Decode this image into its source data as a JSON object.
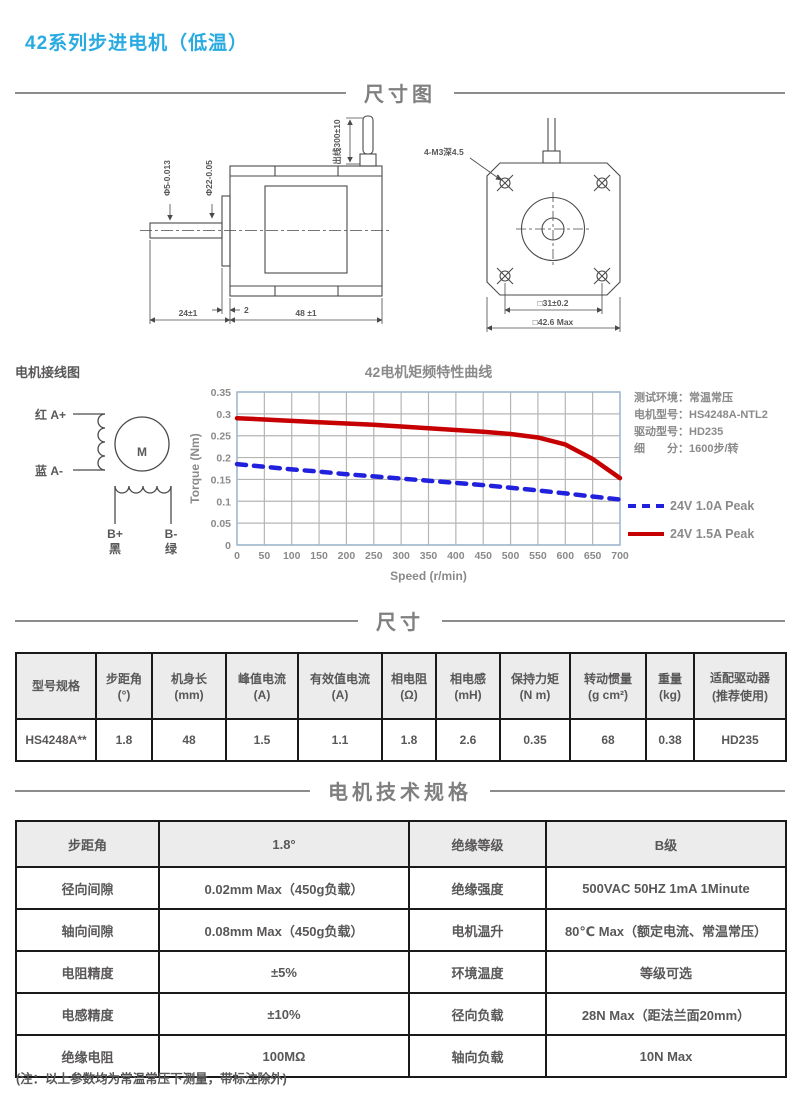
{
  "page": {
    "title": "42系列步进电机（低温）",
    "footnote": "(注：以上参数均为常温常压下测量，带标注除外)",
    "accent_color": "#29abe2"
  },
  "sections": {
    "drawing": "尺寸图",
    "size": "尺寸",
    "tech": "电机技术规格"
  },
  "drawing": {
    "side_view": {
      "wire_label": "出线300±10",
      "screw_label": "4-M3深4.5",
      "shaft_dia": "Φ5-0.013",
      "pilot_dia": "Φ22-0.05",
      "shaft_len": "24±1",
      "pilot_step": "2",
      "body_len": "48 ±1"
    },
    "front_view": {
      "hole_pitch": "□31±0.2",
      "outline": "□42.6 Max"
    }
  },
  "wiring": {
    "title": "电机接线图",
    "motor": "M",
    "lead_a_plus": "红 A+",
    "lead_a_minus": "蓝 A-",
    "lead_b_plus": "B+",
    "lead_b_plus_color": "黑",
    "lead_b_minus": "B-",
    "lead_b_minus_color": "绿"
  },
  "chart_notes": [
    "测试环境：常温常压",
    "电机型号：HS4248A-NTL2",
    "驱动型号：HD235",
    "细　　分：1600步/转"
  ],
  "chart_data": {
    "type": "line",
    "title": "42电机矩频特性曲线",
    "xlabel": "Speed (r/min)",
    "ylabel": "Torque (Nm)",
    "xlim": [
      0,
      700
    ],
    "ylim": [
      0,
      0.35
    ],
    "xticks": [
      0,
      50,
      100,
      150,
      200,
      250,
      300,
      350,
      400,
      450,
      500,
      550,
      600,
      650,
      700
    ],
    "yticks": [
      0,
      0.05,
      0.1,
      0.15,
      0.2,
      0.25,
      0.3,
      0.35
    ],
    "grid": true,
    "legend_position": "right",
    "frame_color": "#9db7cf",
    "grid_color": "#b5b5b5",
    "series": [
      {
        "name": "24V 1.0A Peak",
        "color": "#2121dd",
        "style": "dashed",
        "x": [
          0,
          50,
          100,
          150,
          200,
          250,
          300,
          350,
          400,
          450,
          500,
          550,
          600,
          650,
          700
        ],
        "y": [
          0.185,
          0.179,
          0.173,
          0.168,
          0.162,
          0.157,
          0.152,
          0.147,
          0.142,
          0.137,
          0.131,
          0.125,
          0.118,
          0.111,
          0.104
        ]
      },
      {
        "name": "24V 1.5A Peak",
        "color": "#c60000",
        "style": "solid",
        "x": [
          0,
          50,
          100,
          150,
          200,
          250,
          300,
          350,
          400,
          450,
          500,
          550,
          600,
          650,
          700
        ],
        "y": [
          0.29,
          0.287,
          0.284,
          0.281,
          0.278,
          0.275,
          0.271,
          0.267,
          0.263,
          0.259,
          0.254,
          0.246,
          0.23,
          0.197,
          0.153
        ]
      }
    ]
  },
  "spec_table": {
    "headers": [
      {
        "name": "型号规格",
        "unit": ""
      },
      {
        "name": "步距角",
        "unit": "(°)"
      },
      {
        "name": "机身长",
        "unit": "(mm)"
      },
      {
        "name": "峰值电流",
        "unit": "(A)"
      },
      {
        "name": "有效值电流",
        "unit": "(A)"
      },
      {
        "name": "相电阻",
        "unit": "(Ω)"
      },
      {
        "name": "相电感",
        "unit": "(mH)"
      },
      {
        "name": "保持力矩",
        "unit": "(N m)"
      },
      {
        "name": "转动惯量",
        "unit": "(g cm²)"
      },
      {
        "name": "重量",
        "unit": "(kg)"
      },
      {
        "name": "适配驱动器",
        "unit": "(推荐使用)"
      }
    ],
    "row": [
      "HS4248A**",
      "1.8",
      "48",
      "1.5",
      "1.1",
      "1.8",
      "2.6",
      "0.35",
      "68",
      "0.38",
      "HD235"
    ]
  },
  "tech_table": {
    "rows": [
      [
        "步距角",
        "1.8°",
        "绝缘等级",
        "B级"
      ],
      [
        "径向间隙",
        "0.02mm Max（450g负载）",
        "绝缘强度",
        "500VAC 50HZ 1mA 1Minute"
      ],
      [
        "轴向间隙",
        "0.08mm Max（450g负载）",
        "电机温升",
        "80℃ Max（额定电流、常温常压）"
      ],
      [
        "电阻精度",
        "±5%",
        "环境温度",
        "等级可选"
      ],
      [
        "电感精度",
        "±10%",
        "径向负载",
        "28N Max（距法兰面20mm）"
      ],
      [
        "绝缘电阻",
        "100MΩ",
        "轴向负载",
        "10N  Max"
      ]
    ]
  }
}
